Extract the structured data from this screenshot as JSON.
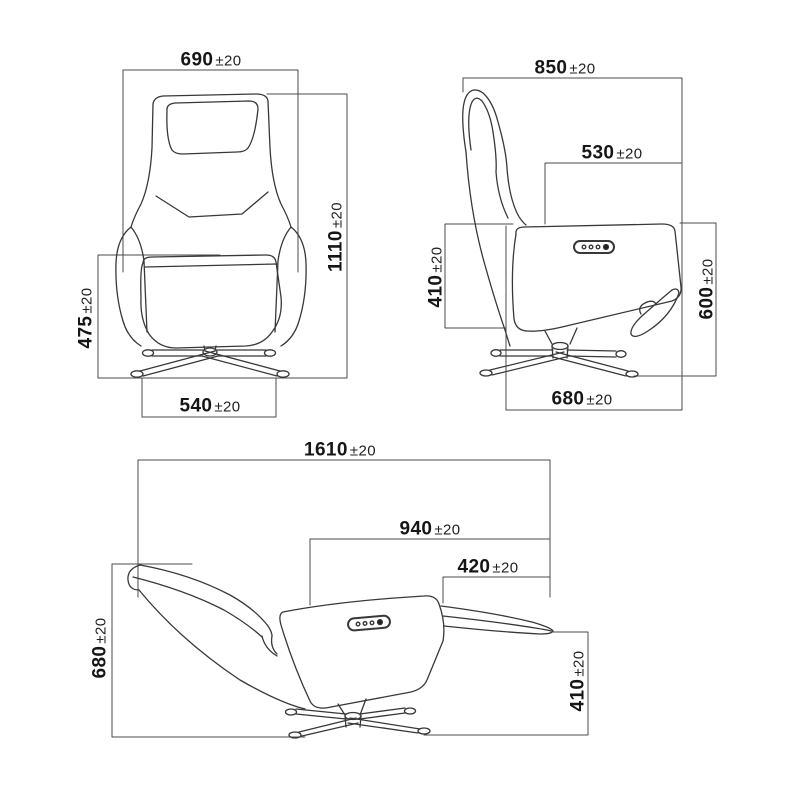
{
  "drawing": {
    "background": "#ffffff",
    "line_color": "#3a3a3a",
    "dim_line_color": "#4b4b4b",
    "views": {
      "front": {
        "dims": {
          "width_top": {
            "value": "690",
            "tol": "±20"
          },
          "height_total": {
            "value": "1110",
            "tol": "±20"
          },
          "height_footrest": {
            "value": "475",
            "tol": "±20"
          },
          "base_width": {
            "value": "540",
            "tol": "±20"
          }
        }
      },
      "side": {
        "dims": {
          "total_depth": {
            "value": "850",
            "tol": "±20"
          },
          "seat_depth": {
            "value": "530",
            "tol": "±20"
          },
          "seat_front_height": {
            "value": "410",
            "tol": "±20"
          },
          "seat_back_height": {
            "value": "600",
            "tol": "±20"
          },
          "base_depth": {
            "value": "680",
            "tol": "±20"
          }
        }
      },
      "reclined": {
        "dims": {
          "total_length": {
            "value": "1610",
            "tol": "±20"
          },
          "seat_length": {
            "value": "940",
            "tol": "±20"
          },
          "footrest_length": {
            "value": "420",
            "tol": "±20"
          },
          "back_height": {
            "value": "680",
            "tol": "±20"
          },
          "footrest_height": {
            "value": "410",
            "tol": "±20"
          }
        }
      }
    }
  }
}
